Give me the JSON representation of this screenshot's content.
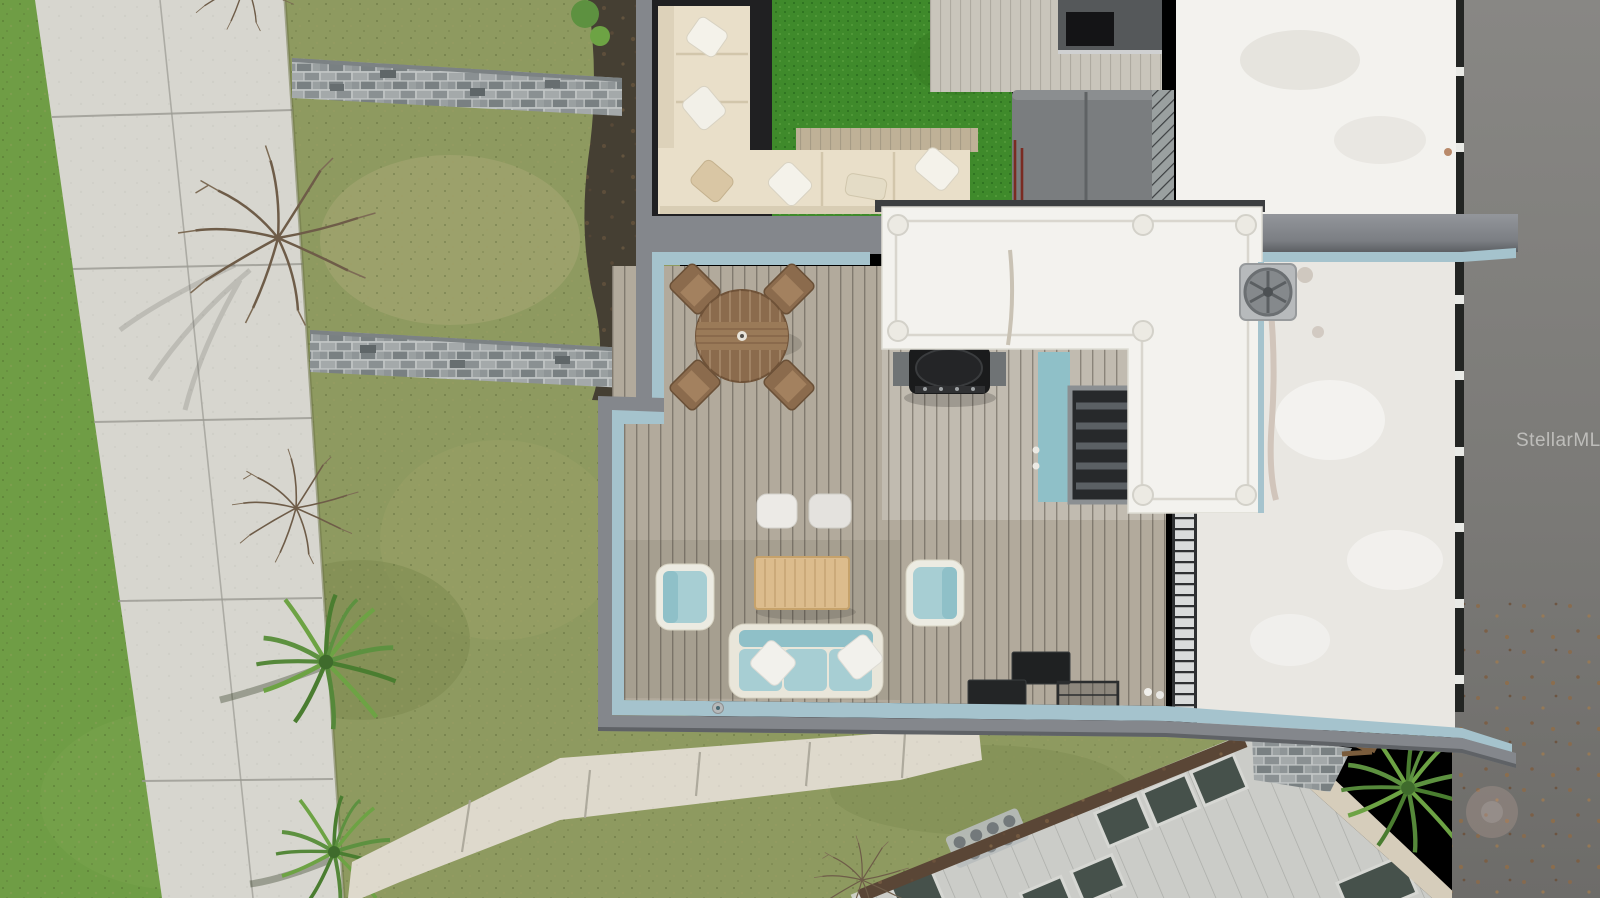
{
  "image": {
    "type": "aerial-drone-photograph",
    "description": "Overhead aerial view of a modern townhome rooftop deck with outdoor furniture, artificial turf, covered hot tub, white flat roofs, surrounding lawn, sidewalks, a street and a neighboring rooftop with skylights"
  },
  "watermark": {
    "text": "StellarMLS"
  },
  "palette": {
    "lawn": "#8e9a60",
    "lawnBright": "#6f9d45",
    "lawnPale": "#a8a775",
    "sidewalk": "#d7d6cf",
    "walkway": "#ded9cc",
    "paver": "#9aa0a2",
    "paverDark": "#6d7375",
    "mulch": "#453f33",
    "deck": "#b2aa9c",
    "deckLight": "#c9c5bb",
    "deckGap": "#6e6860",
    "teal": "#a5c3cd",
    "fascia": "#84878c",
    "fasciaDark": "#5f6266",
    "turf": "#3f8a2b",
    "cream": "#e9dfc9",
    "creamShadow": "#d8cdb4",
    "darkFloor": "#202022",
    "whiteRoof": "#f3f2ee",
    "roofRight": "#e9e7e2",
    "road": "#7f7e7b",
    "roadDark": "#6f6e6b",
    "neighborRoof": "#cbccc8",
    "skylight": "#46514b",
    "aqua": "#a7ced3",
    "aquaDeep": "#8fc0c8",
    "wood": "#8b6b4d",
    "woodLight": "#dcbc8d",
    "hotTub": "#7a7d7f",
    "grillBlack": "#1a1b1c",
    "watermarkColor": "rgba(233,233,230,0.6)"
  },
  "scene": {
    "objects": [
      "concrete-sidewalk",
      "paver-path",
      "lawn",
      "bare-tree",
      "palm-tree",
      "mulch-bed",
      "outdoor-sectional-sofa",
      "artificial-turf",
      "hot-tub",
      "rooftop-deck",
      "round-dining-table",
      "dining-chair",
      "gas-grill",
      "stairwell-opening",
      "roof-access-structure",
      "ac-vent-fan",
      "ottoman-pouf",
      "coffee-table",
      "teal-armchair",
      "teal-sofa",
      "metal-planter-box",
      "roof-ladder",
      "privacy-fence",
      "street",
      "neighbor-roof",
      "skylight",
      "roof-vent-pipes",
      "concrete-walkway"
    ]
  }
}
